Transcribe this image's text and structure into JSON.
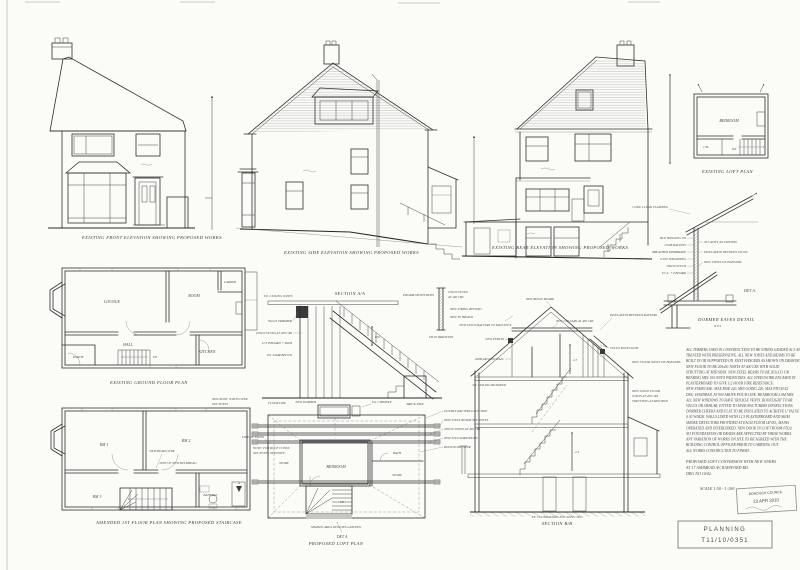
{
  "captions": {
    "front": "EXISTING FRONT ELEVATION SHOWING PROPOSED WORKS",
    "side": "EXISTING SIDE ELEVATION SHOWING PROPOSED WORKS",
    "rear": "EXISTING REAR ELEVATION SHOWING PROPOSED WORKS",
    "loftExisting": "EXISTING LOFT PLAN",
    "ground": "EXISTING GROUND FLOOR PLAN",
    "first": "AMENDED 1ST FLOOR PLAN SHOWING PROPOSED STAIRCASE",
    "loftProposed": "PROPOSED LOFT PLAN",
    "stairSection": "SECTION A/A",
    "sectionBB": "SECTION B/B",
    "detA": "DORMER EAVES DETAIL",
    "detAScale": "N.T.S.",
    "detARef": "DET A.",
    "detARef2": "DET A"
  },
  "ground": {
    "lounge": "LOUNGE",
    "room": "ROOM",
    "kitchen": "KITCHEN",
    "hall": "HALL",
    "porch": "PORCH",
    "larder": "LARDER",
    "up": "UP"
  },
  "first": {
    "rm1": "RM 1",
    "rm2": "RM 2",
    "rm3": "RM 3",
    "bath": "BATH RM",
    "beam": "NEW BEAM OVER",
    "bulkhead": "LINE OF NEW BULKHEAD",
    "n1a": "NEW ROOF JOISTS OVER",
    "n1b": "SEE NOTES",
    "n2a": "NOTE: FOR ROOF CONST.",
    "n2b": "SEE NOTES OPPOSITE",
    "secA": "A"
  },
  "loftE": {
    "bedroom": "BEDROOM",
    "cyl": "CYL",
    "dn": "DN"
  },
  "loftP": {
    "bedroom": "BEDROOM",
    "store": "STORE",
    "bath": "BATH",
    "store2": "STORE",
    "up": "UP",
    "l1": "DOUBLE RAFTERS EACH SIDE",
    "l2": "NEW STEEL BEAMS SEE NOTES",
    "l3": "200x50 JOISTS AT 400 CRS",
    "l4": "NEW STUD PARTITIONS",
    "l5": "ROOFLIGHT OVER",
    "left1": "LINE OF EAVES",
    "top1": "NEW DORMER",
    "top2": "EX. CHIMNEY",
    "bottom": "SHADED AREA DENOTES LANDING"
  },
  "stair": {
    "g1": "50x225 TRIMMER",
    "g2": "EX. CEILING JOISTS",
    "g3": "NEW STRING BEYOND",
    "g4": "100x50 STUDS AT 400 CRS",
    "g5": "12.5 P.BOARD + SKIM",
    "g6": "EX. STAIR BELOW",
    "g7": "NEW 38 TREADS",
    "g8": "BRICK PIER",
    "g9": "850",
    "g10": "FLOOR LINE"
  },
  "stud": {
    "h1": "100x50 STUDS",
    "h2": "AT 400 CRS",
    "h3": "P.BOARD BOTH SIDES",
    "h4": "STUD PARTITION"
  },
  "bb": {
    "b1": "NEW RIDGE BOARD",
    "b2": "NEW 100x50 RAFTERS TO MATCH EX.",
    "b3": "NEW COLLARS AT 400 CRS",
    "b4": "INSULATION BETWEEN RAFTERS",
    "b5": "NEW PURLIN",
    "b6": "ASHLAR STUD WALL",
    "b7": "VELUX ROOFLIGHT",
    "b8": "NEW FLOOR JOISTS ON HANGERS",
    "b9": "EX. CEILING RETAINED",
    "b11a": "NEW 200x50 FLOOR",
    "b11b": "JOISTS AT 400 CRS",
    "b11c": "STRUTTING AT MID SPAN",
    "b12": "EX. FOUNDATIONS NOT AFFECTED",
    "dim1": "2.3",
    "dim2": "2.3"
  },
  "det": {
    "d1": "TILE HANGING ON",
    "d2": "25x38 BATTENS",
    "d3": "BREATHER MEMBRANE",
    "d4": "9 PLY SHEATHING",
    "d5": "100x50 STUDS",
    "d6": "V.C.L. + P.BOARD",
    "d7": "CODE 4 LEAD FLASHING",
    "d8": "50 CAVITY AS EXISTING",
    "d9": "INSULATION BETWEEN STUDS",
    "d10": "NEW JOISTS ON HANGERS"
  },
  "notes": {
    "lines": [
      "ALL TIMBERS USED IN CONSTRUCTION TO BE STRESS GRADED SC3 AND",
      "TREATED WITH PRESERVATIVE. ALL NEW JOISTS AND BEAMS TO BE",
      "BUILT IN OR SUPPORTED ON JOIST HANGERS AS SHOWN ON DRAWINGS.",
      "NEW FLOOR TO BE 200x50 JOISTS AT 400 CRS WITH SOLID",
      "STRUTTING AT MID SPAN. NEW STEEL BEAMS TO BE 203x133 UB",
      "BEARING MIN 100 ONTO PADSTONES. ALL STEELWORK ENCASED IN",
      "PLASTERBOARD TO GIVE 1/2 HOUR FIRE RESISTANCE.",
      "NEW STAIRCASE: MAX RISE 220, MIN GOING 220, MAX PITCH 42",
      "DEG. HANDRAIL AT 900 ABOVE PITCH LINE. HEADROOM 2.0M MIN.",
      "ALL NEW WINDOWS TO HAVE TRICKLE VENTS. ROOFLIGHT TO BE",
      "VELUX OR SIMILAR, FITTED TO MANUFACTURERS INSTRUCTIONS.",
      "DORMER CHEEKS AND FLAT TO BE INSULATED TO ACHIEVE U VALUE",
      "0.30 W/M2K. WALLS LINED WITH 12.5 PLASTERBOARD AND SKIM.",
      "SMOKE DETECTORS PROVIDED AT EACH FLOOR LEVEL, MAINS",
      "OPERATED AND INTERLINKED. NEW DOOR TO LOFT ROOM FD20.",
      "NO FOUNDATIONS OR DRAINS ARE AFFECTED BY THESE WORKS.",
      "ANY VARIATION OF WORKS ON SITE TO BE AGREED WITH THE",
      "BUILDING CONTROL OFFICER PRIOR TO CARRYING OUT.",
      "ALL WORKS CONSTRUCTED TO FINISH."
    ]
  },
  "title": {
    "l1": "PROPOSED LOFT CONVERSION WITH NEW STAIRS",
    "l2": "AT 17 ASHMEAD AV, RAINFORD RD.",
    "l3": "DRG NO 10/02.",
    "scale": "SCALE 1:50 - 1:100"
  },
  "stamp": {
    "council": "BOROUGH COUNCIL",
    "date": "23 APR 2010"
  },
  "planning": {
    "label": "PLANNING",
    "ref": "T11/10/0351"
  }
}
